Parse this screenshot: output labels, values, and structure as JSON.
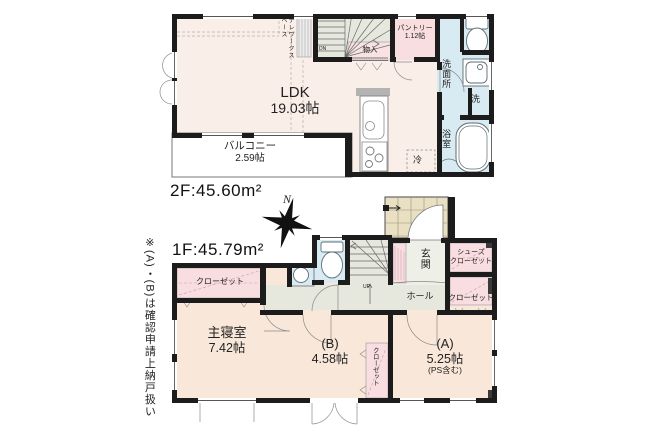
{
  "document_type": "floor-plan",
  "floor2": {
    "title": "2F:45.60m²",
    "rooms": {
      "ldk": {
        "name": "LDK",
        "size": "19.03帖"
      },
      "balcony": {
        "name": "バルコニー",
        "size": "2.59帖"
      },
      "pantry": {
        "name": "パントリー",
        "size": "1.12帖"
      },
      "storage": {
        "name": "物入"
      },
      "telework": {
        "name": "テレワークスペース"
      },
      "washroom": {
        "name": "洗面所"
      },
      "washer": {
        "name": "洗"
      },
      "bathroom": {
        "name": "浴室"
      },
      "fridge": {
        "name": "冷"
      },
      "stairs_label": "DN"
    }
  },
  "floor1": {
    "title": "1F:45.79m²",
    "rooms": {
      "master": {
        "name": "主寝室",
        "size": "7.42帖"
      },
      "room_b": {
        "name": "(B)",
        "size": "4.58帖"
      },
      "room_a": {
        "name": "(A)",
        "size": "5.25帖",
        "note": "(PS含む)"
      },
      "entrance": {
        "name": "玄関"
      },
      "hall": {
        "name": "ホール"
      },
      "shoe_closet": {
        "name": "シューズ\nクローゼット"
      },
      "closet_master": {
        "name": "クローゼット"
      },
      "closet_a": {
        "name": "クローゼット"
      },
      "closet_b": {
        "name": "クローゼット"
      },
      "stairs_label": "UP"
    }
  },
  "compass": {
    "label": "N"
  },
  "side_note": "※(A)・(B)は確認申請上納戸扱い",
  "colors": {
    "wall": "#1c1c1c",
    "ldk_floor": "#faeee9",
    "bedroom_floor": "#f9e8da",
    "wet_area": "#d8eaf2",
    "closet": "#f8dde1",
    "hall_stairs": "#e6e8de",
    "porch_tile": "#e9e0c3",
    "balcony": "#ffffff"
  }
}
